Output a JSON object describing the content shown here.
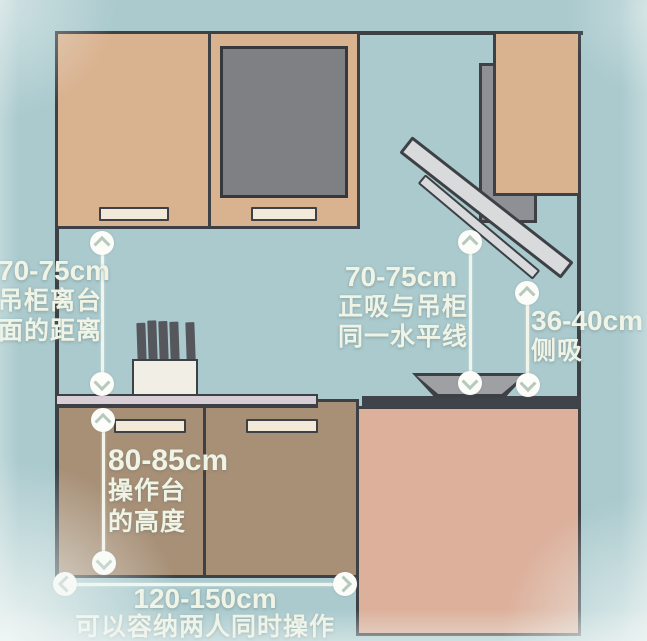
{
  "annotations": {
    "cabinet_gap": {
      "value": "70-75cm",
      "lines": [
        "吊柜离台",
        "面的距离"
      ]
    },
    "hood_level": {
      "value": "70-75cm",
      "lines": [
        "正吸与吊柜",
        "同一水平线"
      ]
    },
    "side_hood": {
      "value": "36-40cm",
      "lines": [
        "侧吸"
      ]
    },
    "counter_height": {
      "value": "80-85cm",
      "lines": [
        "操作台",
        "的高度"
      ]
    },
    "counter_width": {
      "value": "120-150cm",
      "lines": [
        "可以容纳两人同时操作"
      ]
    }
  },
  "colors": {
    "background": "#aacace",
    "outline": "#3d4146",
    "wall_cabinet": "#d9b28f",
    "glass_panel": "#7f8084",
    "base_cabinet_left": "#a89077",
    "base_cabinet_right": "#dcb09b",
    "left_countertop": "#d8ced5",
    "right_countertop": "#3f434a",
    "hood_metal": "#d8dadb",
    "measure_line": "#f2f6ea",
    "annotation_text": "#eff4e6"
  }
}
